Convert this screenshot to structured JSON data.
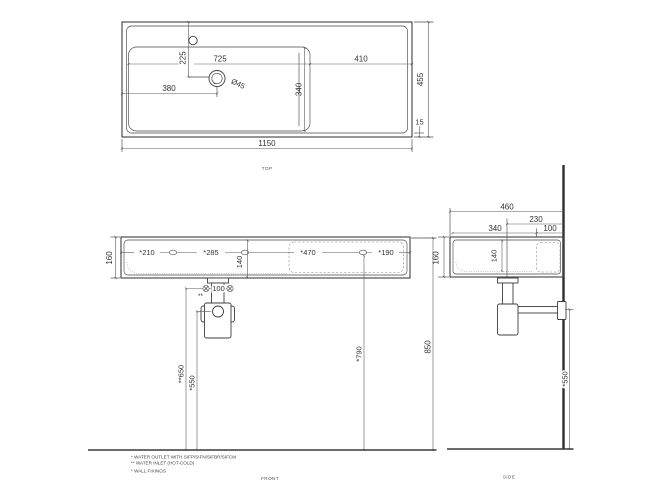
{
  "colors": {
    "line": "#3f3f3f",
    "dim_line": "#5a5a5a",
    "text": "#333333",
    "background": "#ffffff"
  },
  "views": {
    "top": {
      "label": "TOP",
      "dims": {
        "overall_width": "1150",
        "overall_depth": "455",
        "front_rim": "15",
        "bowl_width": "725",
        "deck_width": "410",
        "bowl_depth": "340",
        "drain_from_left": "380",
        "drain_from_back": "225",
        "drain_diameter": "Ø45"
      }
    },
    "front": {
      "label": "FRONT",
      "dims": {
        "height": "160",
        "fixing_left": "*210",
        "fixing_mid": "*285",
        "fixing_right": "*470",
        "fixing_edge": "*190",
        "inner_depth": "140",
        "inlet_spacing": "100",
        "inlet_ref": "**",
        "inlet_height": "**650",
        "waste_height": "*550",
        "fixing_height": "*790",
        "rim_height": "850"
      }
    },
    "side": {
      "label": "SIDE",
      "dims": {
        "overall_depth": "460",
        "waste_from_wall": "230",
        "front_to_tap": "340",
        "tap_from_wall": "100",
        "height": "160",
        "inner_depth": "140",
        "waste_height": "*550"
      }
    }
  },
  "notes": {
    "line1": "*  WATER OUTLET WITH SIFP/SIFN/SIFBR/SIFCM",
    "line2": "** WATER INLET  (HOT-COLD)",
    "line3": "* WALL FIXINGS"
  }
}
